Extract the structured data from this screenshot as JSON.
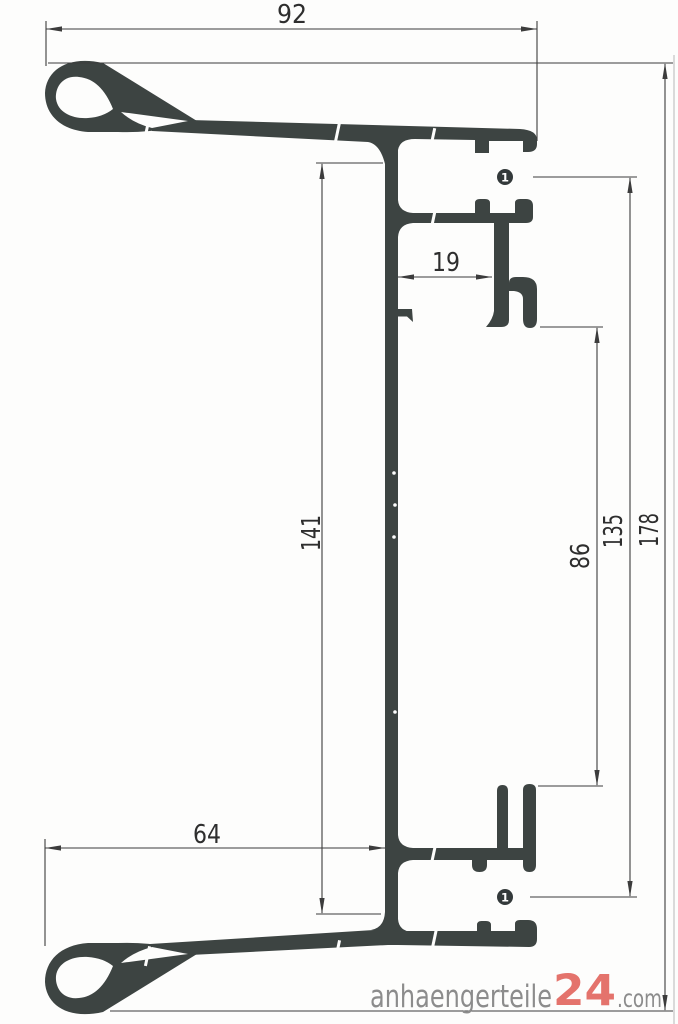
{
  "dimensions": {
    "top_width": "92",
    "bottom_width": "64",
    "hook_offset": "19",
    "web_height": "141",
    "opening_height": "86",
    "marker_spacing": "135",
    "total_height": "178"
  },
  "markers": {
    "top": "1",
    "bottom": "1"
  },
  "watermark": {
    "name": "anhaengerteile",
    "number": "24",
    "tld": ".com"
  },
  "colors": {
    "profile": "#3d4442",
    "dimension_lines": "#3c3c3c",
    "logo_gray": "#8c8c8c",
    "logo_red": "#e4736c"
  }
}
